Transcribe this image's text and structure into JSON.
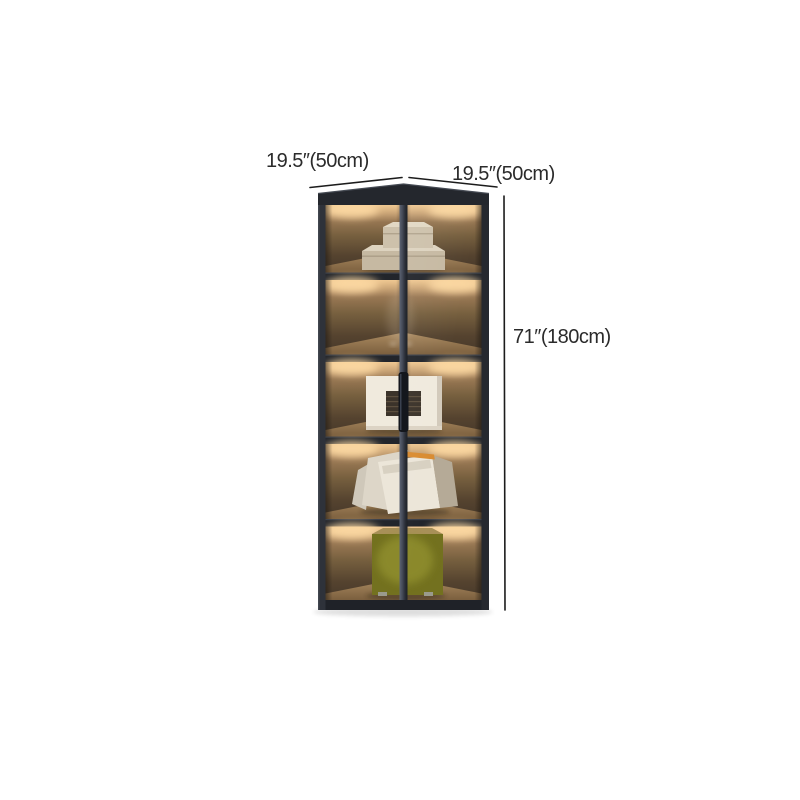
{
  "image": {
    "kind": "product-dimension-photo",
    "subject": "corner display cabinet with five lighted shelves",
    "background_color": "#ffffff"
  },
  "annotations": {
    "text_color": "#2b2b2b",
    "line_color": "#1c1c1c",
    "width_left_label": "19.5″(50cm)",
    "width_right_label": "19.5″(50cm)",
    "height_label": "71″(180cm)"
  },
  "cabinet": {
    "shelf_count": 5,
    "frame_color": "#22252b",
    "mullion_color": "#4a5160",
    "interior_lit_color": "#c79d6e",
    "interior_shadow_color": "#46382a",
    "shelf_floor_color": "#9b7c57",
    "led_glow_color": "#ffd9a0",
    "shelves": [
      {
        "slot": 1,
        "content": "stacked-cream-storage-boxes"
      },
      {
        "slot": 2,
        "content": "faint-glass-figurine"
      },
      {
        "slot": 3,
        "content": "white-framed-artwork"
      },
      {
        "slot": 4,
        "content": "leaning-magazines-orange-spine"
      },
      {
        "slot": 5,
        "content": "olive-green-storage-cube"
      }
    ]
  }
}
